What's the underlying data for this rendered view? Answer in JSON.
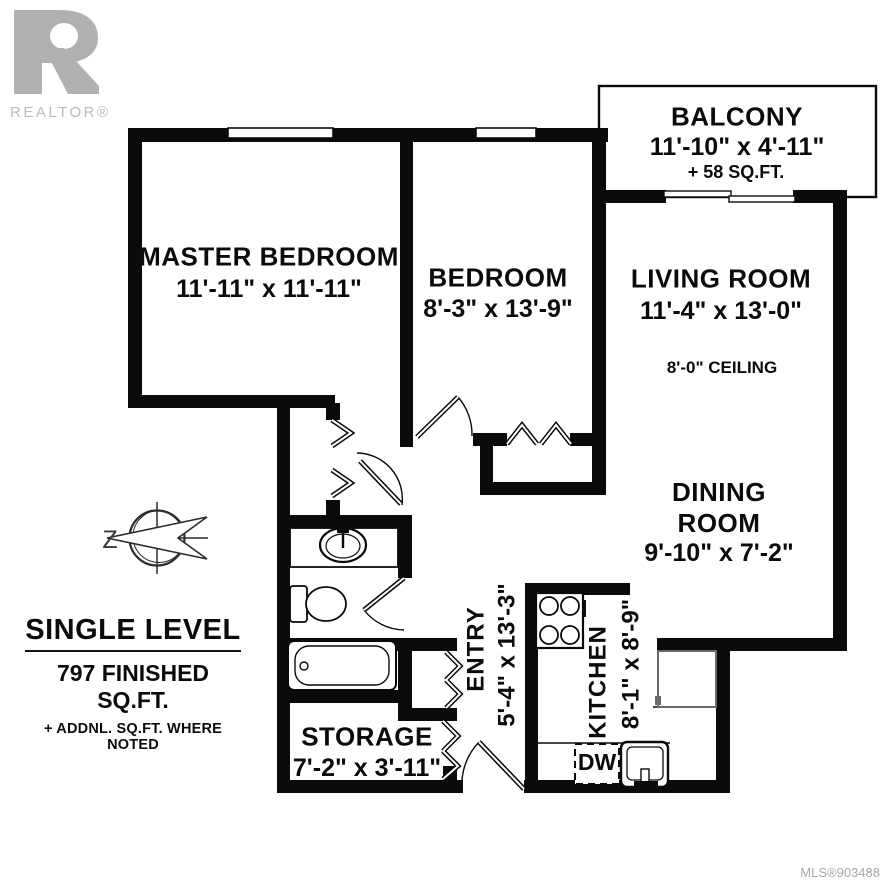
{
  "branding": {
    "logo_letter": "R",
    "logo_text": "REALTOR®"
  },
  "rooms": {
    "balcony": {
      "name": "BALCONY",
      "dims": "11'-10\" x 4'-11\"",
      "extra": "+ 58 SQ.FT."
    },
    "master": {
      "name": "MASTER BEDROOM",
      "dims": "11'-11\" x 11'-11\""
    },
    "bedroom": {
      "name": "BEDROOM",
      "dims": "8'-3\" x 13'-9\""
    },
    "living": {
      "name": "LIVING ROOM",
      "dims": "11'-4\" x 13'-0\"",
      "ceiling": "8'-0\" CEILING"
    },
    "dining": {
      "name": "DINING ROOM",
      "dims": "9'-10\" x 7'-2\""
    },
    "entry": {
      "name": "ENTRY",
      "dims": "5'-4\" x 13'-3\""
    },
    "kitchen": {
      "name": "KITCHEN",
      "dims": "8'-1\" x 8'-9\""
    },
    "storage": {
      "name": "STORAGE",
      "dims": "7'-2\" x 3'-11\""
    }
  },
  "fixtures": {
    "dishwasher_label": "DW"
  },
  "summary": {
    "title": "SINGLE LEVEL",
    "area": "797 FINISHED SQ.FT.",
    "note": "+ ADDNL. SQ.FT. WHERE NOTED"
  },
  "compass": {
    "label": "Z"
  },
  "footer": {
    "mls": "MLS®903488"
  },
  "colors": {
    "wall": "#0a0a0a",
    "logo_gray": "#b2b0b0",
    "mls_gray": "#a9a9a9"
  }
}
